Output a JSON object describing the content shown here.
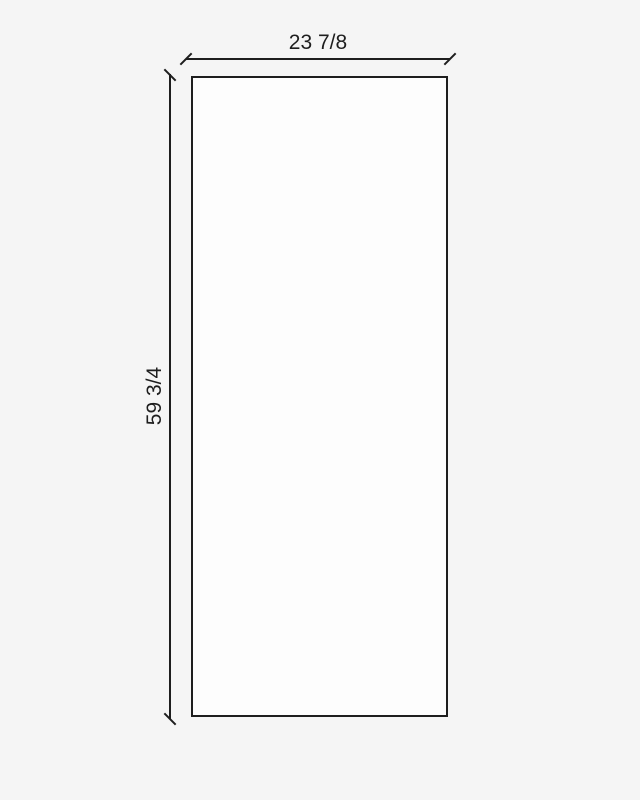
{
  "drawing": {
    "type": "dimensioned-panel-drawing",
    "shape": "rectangle",
    "dimensions": {
      "width_label": "23 7/8",
      "height_label": "59 3/4"
    }
  },
  "colors": {
    "background": "#f5f5f5",
    "panel_fill": "#fdfdfd",
    "line": "#1e1e1e",
    "text": "#1e1e1e"
  }
}
